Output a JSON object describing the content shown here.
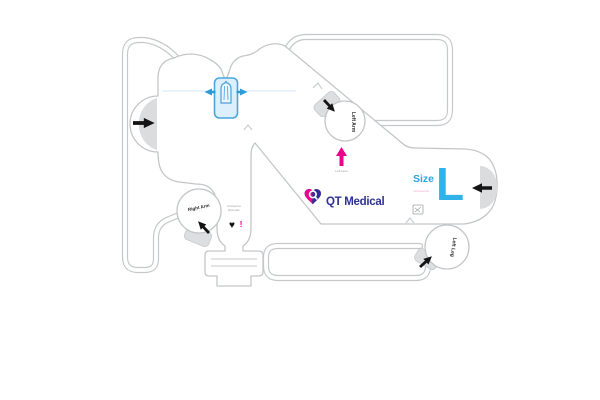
{
  "page": {
    "background": "#ffffff"
  },
  "brand": {
    "name": "QT Medical",
    "navy": "#2e3192",
    "magenta": "#ec008c",
    "light_blue": "#29abe2",
    "connector_blue": "#4ba6de"
  },
  "size_panel": {
    "label": "Size",
    "value": "L",
    "code": "~~~~~~"
  },
  "electrode_labels": {
    "left_arm": "Left Arm",
    "right_arm": "Right Arm",
    "left_leg": "Left Leg"
  },
  "markers": {
    "apex_label": "Left Apex",
    "note_line1": "Connect to",
    "note_line2": "Recorder",
    "heart_glyph": "♥",
    "alert_glyph": "!"
  }
}
